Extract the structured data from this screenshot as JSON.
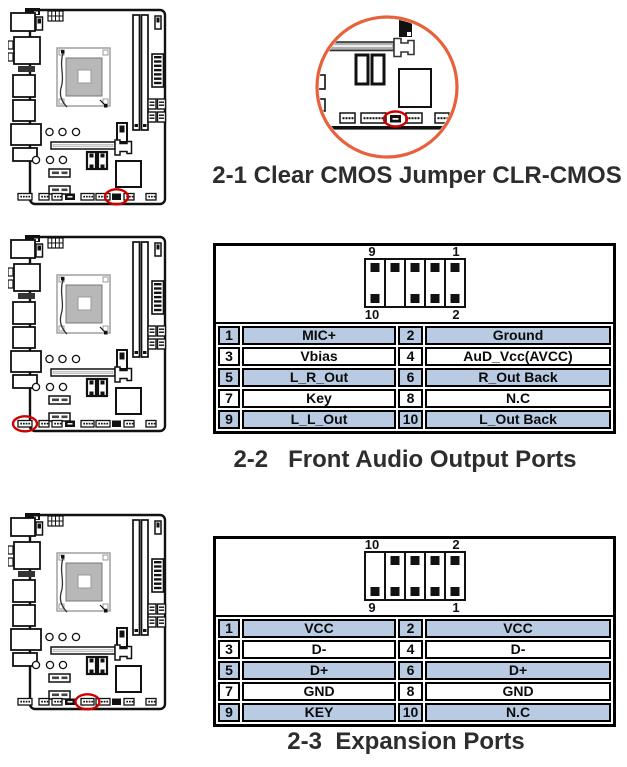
{
  "colors": {
    "table_row_blue": "#b8cbe2",
    "highlight_red": "#cc0000",
    "inset_orange": "#e8613d",
    "caption_text": "#2d2d2d",
    "line_black": "#111111"
  },
  "sections": [
    {
      "id": "clear-cmos",
      "caption": "2-1 Clear CMOS Jumper CLR-CMOS",
      "highlight": {
        "cx": 108.5,
        "cy": 188.8,
        "rx": 11.5,
        "ry": 7.5
      },
      "inset_highlight": {
        "cx": 83.5,
        "cy": 107,
        "rx": 11.5,
        "ry": 7.5
      }
    },
    {
      "id": "front-audio",
      "caption": "2-2   Front Audio Output Ports",
      "highlight": {
        "cx": 17,
        "cy": 188.8,
        "rx": 12,
        "ry": 7.5
      },
      "pin_header": {
        "top_left": "9",
        "top_right": "1",
        "bottom_left": "10",
        "bottom_right": "2",
        "top_pins": [
          true,
          true,
          true,
          true,
          true
        ],
        "bottom_pins": [
          true,
          false,
          true,
          true,
          true
        ]
      },
      "pin_rows": [
        {
          "n1": "1",
          "f1": "MIC+",
          "n2": "2",
          "f2": "Ground",
          "shaded": true
        },
        {
          "n1": "3",
          "f1": "Vbias",
          "n2": "4",
          "f2": "AuD_Vcc(AVCC)",
          "shaded": false
        },
        {
          "n1": "5",
          "f1": "L_R_Out",
          "n2": "6",
          "f2": "R_Out Back",
          "shaded": true
        },
        {
          "n1": "7",
          "f1": "Key",
          "n2": "8",
          "f2": "N.C",
          "shaded": false
        },
        {
          "n1": "9",
          "f1": "L_L_Out",
          "n2": "10",
          "f2": "L_Out Back",
          "shaded": true
        }
      ]
    },
    {
      "id": "expansion",
      "caption": "2-3  Expansion Ports",
      "highlight": {
        "cx": 79.5,
        "cy": 188.8,
        "rx": 12,
        "ry": 7.5
      },
      "pin_header": {
        "top_left": "10",
        "top_right": "2",
        "bottom_left": "9",
        "bottom_right": "1",
        "top_pins": [
          false,
          true,
          true,
          true,
          true
        ],
        "bottom_pins": [
          true,
          true,
          true,
          true,
          true
        ]
      },
      "pin_rows": [
        {
          "n1": "1",
          "f1": "VCC",
          "n2": "2",
          "f2": "VCC",
          "shaded": true
        },
        {
          "n1": "3",
          "f1": "D-",
          "n2": "4",
          "f2": "D-",
          "shaded": false
        },
        {
          "n1": "5",
          "f1": "D+",
          "n2": "6",
          "f2": "D+",
          "shaded": true
        },
        {
          "n1": "7",
          "f1": "GND",
          "n2": "8",
          "f2": "GND",
          "shaded": false
        },
        {
          "n1": "9",
          "f1": "KEY",
          "n2": "10",
          "f2": "N.C",
          "shaded": true
        }
      ]
    }
  ]
}
